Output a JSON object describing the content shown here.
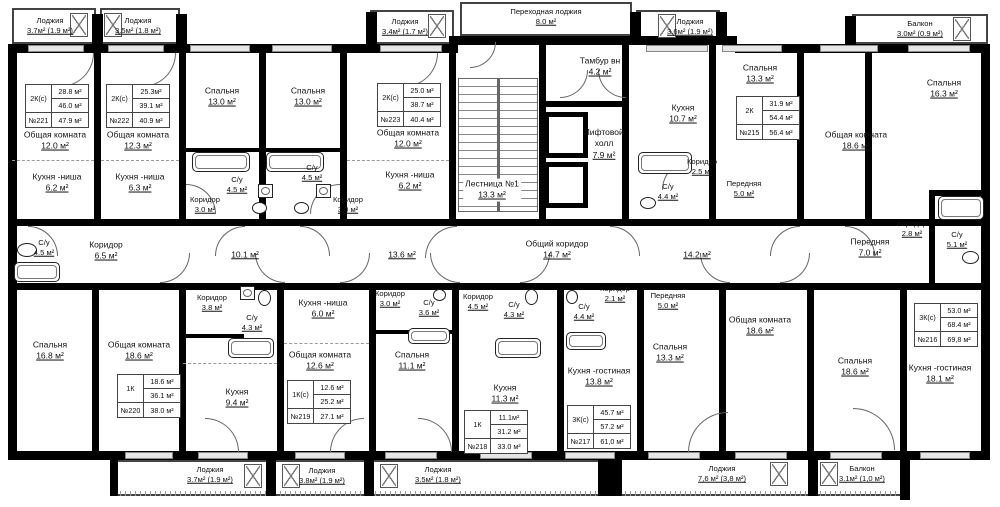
{
  "rooms": [
    {
      "n": "Лоджия",
      "a": "3.7м² (1.9 м²)"
    },
    {
      "n": "Лоджия",
      "a": "3.5м² (1.8 м²)"
    },
    {
      "n": "Лоджия",
      "a": "3.4м² (1.7 м²)"
    },
    {
      "n": "Переходная лоджия",
      "a": "8.0 м²"
    },
    {
      "n": "Лоджия",
      "a": "3.6м² (1.9 м²)"
    },
    {
      "n": "Балкон",
      "a": "3.0м² (0.9 м²)"
    },
    {
      "n": "Общая комната",
      "a": "12.0 м²"
    },
    {
      "n": "Кухня -ниша",
      "a": "6.2 м²"
    },
    {
      "n": "Общая комната",
      "a": "12.3 м²"
    },
    {
      "n": "Кухня -ниша",
      "a": "6.3 м²"
    },
    {
      "n": "Спальня",
      "a": "13.0 м²"
    },
    {
      "n": "Спальня",
      "a": "13.0 м²"
    },
    {
      "n": "С/у",
      "a": "4.5 м²"
    },
    {
      "n": "С/у",
      "a": "4.5 м²"
    },
    {
      "n": "Коридор",
      "a": "3.0 м²"
    },
    {
      "n": "Коридор",
      "a": "3.0 м²"
    },
    {
      "n": "Общая комната",
      "a": "12.0 м²"
    },
    {
      "n": "Кухня -ниша",
      "a": "6.2 м²"
    },
    {
      "n": "Лестница №1",
      "a": "13.3 м²"
    },
    {
      "n": "Тамбур вн",
      "a": "4.2 м²"
    },
    {
      "n": "Лифтовой холл",
      "a": "7.9 м²"
    },
    {
      "n": "Кухня",
      "a": "10.7 м²"
    },
    {
      "n": "Спальня",
      "a": "13.3 м²"
    },
    {
      "n": "Коридор",
      "a": "2.5 м²"
    },
    {
      "n": "С/у",
      "a": "4.4 м²"
    },
    {
      "n": "Передняя",
      "a": "5.0 м²"
    },
    {
      "n": "Общая комната",
      "a": "18.6 м²"
    },
    {
      "n": "Спальня",
      "a": "16.3 м²"
    },
    {
      "n": "Коридор",
      "a": "2.8 м²"
    },
    {
      "n": "С/у",
      "a": "5.1 м²"
    },
    {
      "n": "Передняя",
      "a": "7.0 м²"
    },
    {
      "n": "С/у",
      "a": "4.5 м²"
    },
    {
      "n": "Коридор",
      "a": "6.5 м²"
    },
    {
      "n": "",
      "a": "10.1 м²"
    },
    {
      "n": "",
      "a": "13.6 м²"
    },
    {
      "n": "Общий коридор",
      "a": "14.7 м²"
    },
    {
      "n": "",
      "a": "14.2 м²"
    },
    {
      "n": "Коридор",
      "a": "3.8 м²"
    },
    {
      "n": "С/у",
      "a": "4.3 м²"
    },
    {
      "n": "Спальня",
      "a": "16.8 м²"
    },
    {
      "n": "Общая комната",
      "a": "18.6 м²"
    },
    {
      "n": "Кухня",
      "a": "9.4 м²"
    },
    {
      "n": "Кухня -ниша",
      "a": "6.0 м²"
    },
    {
      "n": "Общая комната",
      "a": "12.6 м²"
    },
    {
      "n": "Коридор",
      "a": "3.0 м²"
    },
    {
      "n": "С/у",
      "a": "3.6 м²"
    },
    {
      "n": "Спальня",
      "a": "11.1 м²"
    },
    {
      "n": "Коридор",
      "a": "4.5 м²"
    },
    {
      "n": "С/у",
      "a": "4.3 м²"
    },
    {
      "n": "Кухня",
      "a": "11.3 м²"
    },
    {
      "n": "С/у",
      "a": "4.4 м²"
    },
    {
      "n": "Коридор",
      "a": "2.1 м²"
    },
    {
      "n": "Кухня -гостиная",
      "a": "13.8 м²"
    },
    {
      "n": "Передняя",
      "a": "5.0 м²"
    },
    {
      "n": "Спальня",
      "a": "13.3 м²"
    },
    {
      "n": "Общая комната",
      "a": "18.6 м²"
    },
    {
      "n": "Спальня",
      "a": "18.6 м²"
    },
    {
      "n": "Кухня -гостиная",
      "a": "18.1 м²"
    },
    {
      "n": "Лоджия",
      "a": "3.7м² (1.9 м²)"
    },
    {
      "n": "Лоджия",
      "a": "3.8м² (1.9 м²)"
    },
    {
      "n": "Лоджия",
      "a": "3.5м² (1.8 м²)"
    },
    {
      "n": "Лоджия",
      "a": "7,6 м² (3,8 м²)"
    },
    {
      "n": "Балкон",
      "a": "3.1м² (1,0 м²)"
    }
  ],
  "tables": [
    {
      "t": "2К(с)",
      "a1": "28.8 м²",
      "a2": "46.0 м²",
      "num": "№221",
      "tot": "47.9 м²"
    },
    {
      "t": "2К(с)",
      "a1": "25.3м²",
      "a2": "39.1 м²",
      "num": "№222",
      "tot": "40.9 м²"
    },
    {
      "t": "2К(с)",
      "a1": "25.0 м²",
      "a2": "38.7 м²",
      "num": "№223",
      "tot": "40.4 м²"
    },
    {
      "t": "2К",
      "a1": "31.9 м²",
      "a2": "54.4 м²",
      "num": "№215",
      "tot": "56.4 м²"
    },
    {
      "t": "1К",
      "a1": "18.6 м²",
      "a2": "36.1 м²",
      "num": "№220",
      "tot": "38.0 м²"
    },
    {
      "t": "1К(с)",
      "a1": "12.6 м²",
      "a2": "25.2 м²",
      "num": "№219",
      "tot": "27.1 м²"
    },
    {
      "t": "1К",
      "a1": "11.1м²",
      "a2": "31.2 м²",
      "num": "№218",
      "tot": "33.0 м²"
    },
    {
      "t": "3К(с)",
      "a1": "45.7 м²",
      "a2": "57.2 м²",
      "num": "№217",
      "tot": "61,0 м²"
    },
    {
      "t": "3К(с)",
      "a1": "53.0 м²",
      "a2": "68.4 м²",
      "num": "№216",
      "tot": "69,8 м²"
    }
  ]
}
